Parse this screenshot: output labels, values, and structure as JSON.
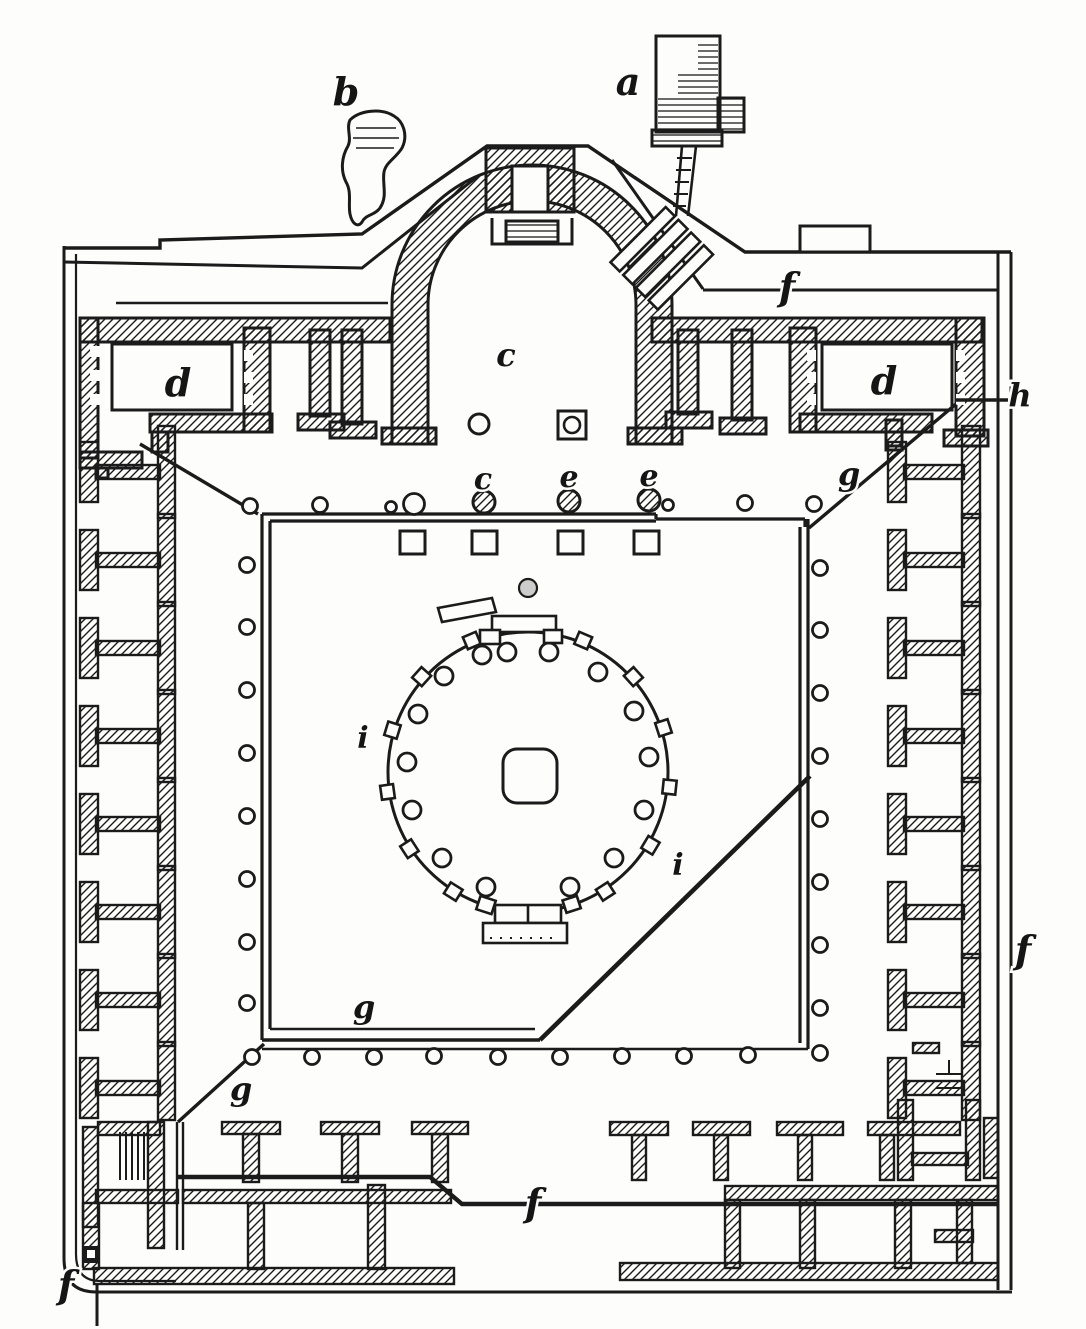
{
  "figure": {
    "kind": "engraved architectural floor plan",
    "palette": {
      "ink": "#1b1b1b",
      "paper": "#fdfdfc",
      "shade": "#cccccc"
    }
  },
  "plan_labels": [
    {
      "id": "a-structure",
      "text": "a"
    },
    {
      "id": "b-rock",
      "text": "b"
    },
    {
      "id": "c-apse-hall",
      "text": "c"
    },
    {
      "id": "d-room-left",
      "text": "d"
    },
    {
      "id": "d-room-right",
      "text": "d"
    },
    {
      "id": "c-column-row",
      "text": "c"
    },
    {
      "id": "e-column-1",
      "text": "e"
    },
    {
      "id": "e-column-2",
      "text": "e"
    },
    {
      "id": "f-top-corridor",
      "text": "f"
    },
    {
      "id": "f-right-edge",
      "text": "f"
    },
    {
      "id": "f-bottom-line",
      "text": "f"
    },
    {
      "id": "f-bottom-corner",
      "text": "f"
    },
    {
      "id": "g-top-right",
      "text": "g"
    },
    {
      "id": "g-courtyard",
      "text": "g"
    },
    {
      "id": "g-below-courtyard",
      "text": "g"
    },
    {
      "id": "h-right-edge",
      "text": "h"
    },
    {
      "id": "i-tholos-left",
      "text": "i"
    },
    {
      "id": "i-tholos-right",
      "text": "i"
    }
  ]
}
